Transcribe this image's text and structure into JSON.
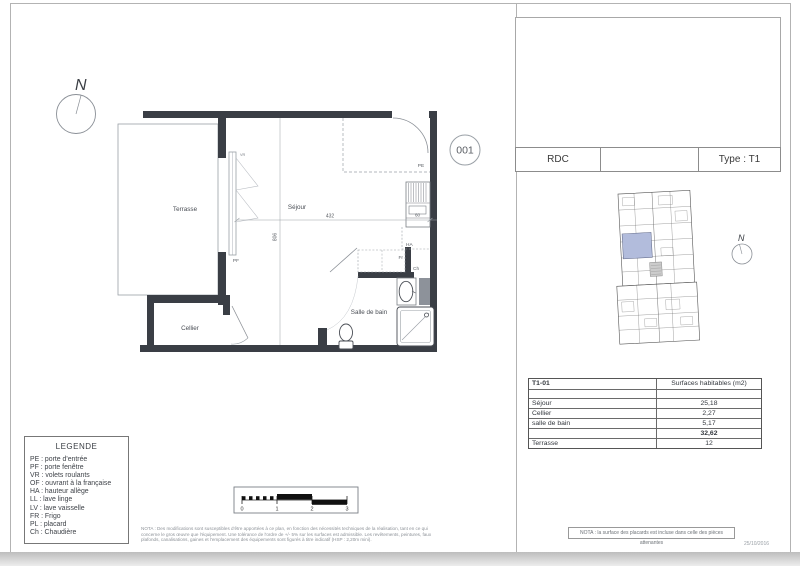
{
  "colors": {
    "wall": "#3a3e45",
    "highlight": "#b2bcdc"
  },
  "compass": {
    "label": "N"
  },
  "unit_number": "001",
  "plan": {
    "rooms": {
      "terrasse": "Terrasse",
      "sejour": "Séjour",
      "cellier": "Cellier",
      "salle_de_bain": "Salle de bain"
    },
    "tags": {
      "pe": "PE",
      "pf": "PF",
      "vr": "VR",
      "fr": "Fr",
      "ch": "Ch",
      "ha": "HA",
      "sink_width": "60"
    },
    "dims": {
      "sejour_width": "432",
      "depth": "806"
    }
  },
  "title_block": {
    "level": "RDC",
    "middle": "",
    "type": "Type : T1"
  },
  "surfaces_table": {
    "unit": "T1-01",
    "header": "Surfaces habitables (m2)",
    "rows": [
      {
        "label": "Séjour",
        "value": "25,18"
      },
      {
        "label": "Cellier",
        "value": "2,27"
      },
      {
        "label": "salle de bain",
        "value": "5,17"
      }
    ],
    "total": "32,62",
    "terrasse": {
      "label": "Terrasse",
      "value": "12"
    }
  },
  "legend": {
    "title": "LEGENDE",
    "items": [
      "PE : porte d'entrée",
      "PF : porte fenêtre",
      "VR : volets roulants",
      "OF : ouvrant à la française",
      "HA : hauteur allège",
      "LL : lave linge",
      "LV : lave vaisselle",
      "FR : Frigo",
      "PL : placard",
      "Ch : Chaudière"
    ]
  },
  "scale_bar": {
    "ticks": [
      "0",
      "1",
      "2",
      "3"
    ]
  },
  "notes": {
    "left": "NOTA : Des modifications sont susceptibles d'être apportées à ce plan, en fonction des nécessités techniques de la réalisation, tant en ce qui concerne le gros œuvre que l'équipement. Une tolérance de l'ordre de +/- 5% sur les surfaces est admissible. Les revêtements, peintures, faux plafonds, canalisations, gaines et l'emplacement des équipements sont figurés à titre indicatif (HSP : 2,20m mini).",
    "right": "NOTA : la surface des placards est incluse dans celle des pièces attenantes",
    "date": "25/10/2016"
  }
}
